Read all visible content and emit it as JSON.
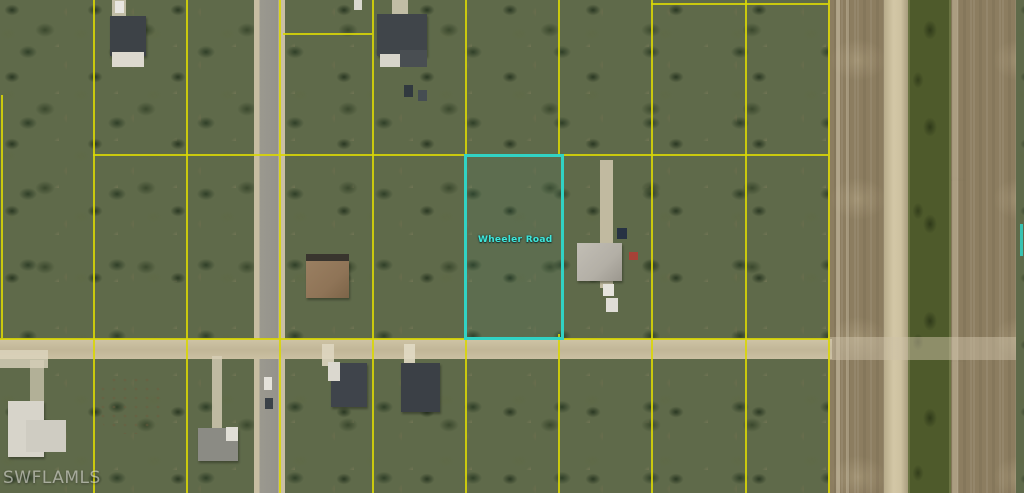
{
  "window": {
    "description": "MLS aerial parcel photo",
    "width": 1024,
    "height": 493
  },
  "watermark": {
    "text": "SWFLAMLS"
  },
  "road_label": {
    "text": "Wheeler Road"
  },
  "palette": {
    "parcel_line": "#d9d606",
    "highlight": "#31d2c4",
    "veg_base": "#5f6a4a",
    "sand": "#cfc3a4",
    "field": "#8c7d60",
    "canal": "#4e5a2b",
    "asphalt": "#98968c",
    "dirt_road": "#c6bb9e"
  },
  "highlight_parcel": {
    "x": 464,
    "y": 154,
    "w": 94,
    "h": 180
  },
  "grid": {
    "vertical": [
      {
        "x": 1,
        "y1": 95,
        "y2": 338
      },
      {
        "x": 93,
        "y1": 0,
        "y2": 493
      },
      {
        "x": 186,
        "y1": 0,
        "y2": 493
      },
      {
        "x": 279,
        "y1": 0,
        "y2": 493
      },
      {
        "x": 372,
        "y1": 0,
        "y2": 493
      },
      {
        "x": 465,
        "y1": 0,
        "y2": 155
      },
      {
        "x": 465,
        "y1": 334,
        "y2": 493
      },
      {
        "x": 558,
        "y1": 0,
        "y2": 155
      },
      {
        "x": 558,
        "y1": 334,
        "y2": 493
      },
      {
        "x": 651,
        "y1": 0,
        "y2": 493
      },
      {
        "x": 745,
        "y1": 0,
        "y2": 493
      },
      {
        "x": 828,
        "y1": 0,
        "y2": 493
      }
    ],
    "horizontal": [
      {
        "y": 3,
        "x1": 651,
        "x2": 828
      },
      {
        "y": 33,
        "x1": 283,
        "x2": 372
      },
      {
        "y": 154,
        "x1": 93,
        "x2": 828
      },
      {
        "y": 338,
        "x1": 0,
        "x2": 829
      }
    ]
  },
  "scene": {
    "ground": [
      {
        "name": "vegetation-base",
        "x": 0,
        "y": 0,
        "w": 1024,
        "h": 493,
        "cls": "veg"
      },
      {
        "name": "field-strip",
        "x": 828,
        "y": 0,
        "w": 196,
        "h": 493,
        "cls": "field"
      },
      {
        "name": "field-path-line",
        "x": 836,
        "y": 0,
        "w": 4,
        "h": 493,
        "bg": "rgba(215,205,180,0.5)"
      },
      {
        "name": "field-path-line",
        "x": 846,
        "y": 0,
        "w": 3,
        "h": 493,
        "bg": "rgba(210,200,175,0.4)"
      },
      {
        "name": "levee-strip",
        "x": 884,
        "y": 0,
        "w": 24,
        "h": 493,
        "cls": "levee"
      },
      {
        "name": "canal",
        "x": 908,
        "y": 0,
        "w": 43,
        "h": 493,
        "cls": "canal"
      },
      {
        "name": "field-east-edge-line",
        "x": 952,
        "y": 0,
        "w": 6,
        "h": 493,
        "bg": "rgba(228,218,192,0.35)"
      },
      {
        "name": "vegetation-sliver-east",
        "x": 1016,
        "y": 0,
        "w": 8,
        "h": 493,
        "cls": "veg"
      }
    ],
    "sand": [
      {
        "name": "sand-clearing",
        "x": 55,
        "y": 90,
        "w": 150,
        "h": 110,
        "op": 0.85
      },
      {
        "name": "sand-clearing",
        "x": 90,
        "y": 0,
        "w": 100,
        "h": 110,
        "op": 0.6
      },
      {
        "name": "sand-clearing",
        "x": 360,
        "y": 0,
        "w": 110,
        "h": 155,
        "op": 0.95
      },
      {
        "name": "sand-clearing",
        "x": 205,
        "y": 0,
        "w": 55,
        "h": 35,
        "op": 0.5
      },
      {
        "name": "sand-clearing",
        "x": 275,
        "y": 190,
        "w": 100,
        "h": 155,
        "op": 0.95
      },
      {
        "name": "sand-clearing",
        "x": 560,
        "y": 225,
        "w": 90,
        "h": 100,
        "op": 0.8
      },
      {
        "name": "sand-clearing",
        "x": 465,
        "y": 215,
        "w": 95,
        "h": 110,
        "op": 0.5
      },
      {
        "name": "sand-clearing",
        "x": 655,
        "y": 55,
        "w": 90,
        "h": 80,
        "op": 0.4
      },
      {
        "name": "sand-clearing",
        "x": 690,
        "y": 345,
        "w": 140,
        "h": 148,
        "op": 0.9
      },
      {
        "name": "sand-clearing",
        "x": 88,
        "y": 362,
        "w": 100,
        "h": 85,
        "op": 0.85
      },
      {
        "name": "sand-clearing",
        "x": 0,
        "y": 385,
        "w": 80,
        "h": 90,
        "op": 0.7
      },
      {
        "name": "sand-clearing",
        "x": 180,
        "y": 410,
        "w": 80,
        "h": 85,
        "op": 0.6
      },
      {
        "name": "sand-clearing",
        "x": 940,
        "y": 300,
        "w": 80,
        "h": 60,
        "op": 0.8
      },
      {
        "name": "sand-clearing",
        "x": 830,
        "y": 0,
        "w": 55,
        "h": 130,
        "op": 0.5
      },
      {
        "name": "mulch-pile",
        "x": 98,
        "y": 376,
        "w": 64,
        "h": 58,
        "cls": "mulch",
        "op": 0.9
      }
    ],
    "roads": [
      {
        "name": "road-vertical",
        "x": 254,
        "y": 0,
        "w": 31,
        "h": 493,
        "bg": "linear-gradient(90deg,#c7bda2 0px,#c7bda2 5px,#9b998f 6px,#94928b 24px,#c9bfa4 25px,#c9bfa4 31px)"
      },
      {
        "name": "road-horizontal",
        "x": 0,
        "y": 339,
        "w": 832,
        "h": 20,
        "bg": "linear-gradient(180deg,#cfc4a6 0%,#c1b697 55%,#cbc0a2 100%)"
      },
      {
        "name": "road-horizontal-fade",
        "x": 828,
        "y": 337,
        "w": 188,
        "h": 23,
        "bg": "rgba(205,194,168,0.5)"
      }
    ],
    "driveways": [
      {
        "name": "driveway",
        "x": 600,
        "y": 160,
        "w": 13,
        "h": 128,
        "bg": "rgba(210,200,175,0.85)"
      },
      {
        "name": "driveway",
        "x": 322,
        "y": 344,
        "w": 12,
        "h": 22,
        "bg": "rgba(222,214,192,0.9)"
      },
      {
        "name": "driveway",
        "x": 404,
        "y": 344,
        "w": 11,
        "h": 20,
        "bg": "rgba(225,218,196,0.9)"
      },
      {
        "name": "driveway",
        "x": 212,
        "y": 356,
        "w": 10,
        "h": 72,
        "bg": "rgba(215,206,182,0.8)"
      },
      {
        "name": "driveway",
        "x": 0,
        "y": 350,
        "w": 48,
        "h": 18,
        "bg": "rgba(220,212,190,0.8)"
      },
      {
        "name": "driveway",
        "x": 30,
        "y": 360,
        "w": 14,
        "h": 42,
        "bg": "rgba(214,206,184,0.7)"
      },
      {
        "name": "driveway",
        "x": 112,
        "y": 0,
        "w": 14,
        "h": 16,
        "bg": "rgba(218,210,188,0.8)"
      },
      {
        "name": "driveway",
        "x": 392,
        "y": 0,
        "w": 16,
        "h": 14,
        "bg": "rgba(218,210,188,0.8)"
      }
    ],
    "structures": [
      {
        "name": "house-roof",
        "x": 110,
        "y": 16,
        "w": 36,
        "h": 40,
        "bg": "#3d4247",
        "cls": "roof"
      },
      {
        "name": "house-roof-section",
        "x": 112,
        "y": 52,
        "w": 32,
        "h": 15,
        "bg": "#ddd9cf"
      },
      {
        "name": "house-roof",
        "x": 377,
        "y": 14,
        "w": 50,
        "h": 42,
        "bg": "#40454a",
        "cls": "roof"
      },
      {
        "name": "house-roof-section",
        "x": 400,
        "y": 50,
        "w": 27,
        "h": 17,
        "bg": "#494e52"
      },
      {
        "name": "house-roof-section",
        "x": 380,
        "y": 54,
        "w": 20,
        "h": 13,
        "bg": "#d7d4ca"
      },
      {
        "name": "house-roof-eave",
        "x": 306,
        "y": 254,
        "w": 43,
        "h": 8,
        "bg": "#39352e"
      },
      {
        "name": "house-roof",
        "x": 306,
        "y": 261,
        "w": 43,
        "h": 37,
        "bg": "linear-gradient(135deg,#9a7f61,#8f7457 60%,#7c6448)",
        "cls": "roof"
      },
      {
        "name": "house-roof",
        "x": 577,
        "y": 243,
        "w": 45,
        "h": 38,
        "bg": "linear-gradient(135deg,#c2beb5,#b3afa6 60%,#9b978e)",
        "cls": "roof"
      },
      {
        "name": "house-roof",
        "x": 8,
        "y": 401,
        "w": 36,
        "h": 56,
        "bg": "#d7d4ca",
        "cls": "roof"
      },
      {
        "name": "house-roof-section",
        "x": 26,
        "y": 420,
        "w": 40,
        "h": 32,
        "bg": "#cfccc2"
      },
      {
        "name": "house-roof",
        "x": 198,
        "y": 428,
        "w": 40,
        "h": 33,
        "bg": "#8b8b84",
        "cls": "roof"
      },
      {
        "name": "house-roof-section",
        "x": 226,
        "y": 427,
        "w": 12,
        "h": 14,
        "bg": "#e0ded6"
      },
      {
        "name": "house-roof",
        "x": 331,
        "y": 363,
        "w": 36,
        "h": 44,
        "bg": "#3f444b",
        "cls": "roof"
      },
      {
        "name": "house-roof-section",
        "x": 328,
        "y": 362,
        "w": 12,
        "h": 19,
        "bg": "#dbd8cf"
      },
      {
        "name": "house-roof",
        "x": 401,
        "y": 363,
        "w": 39,
        "h": 49,
        "bg": "#3b4046",
        "cls": "roof"
      }
    ],
    "vehicles": [
      {
        "name": "vehicle",
        "x": 115,
        "y": 1,
        "w": 9,
        "h": 12,
        "bg": "#e8e6e0"
      },
      {
        "name": "vehicle",
        "x": 354,
        "y": 0,
        "w": 8,
        "h": 10,
        "bg": "#dad8d0"
      },
      {
        "name": "vehicle",
        "x": 404,
        "y": 85,
        "w": 9,
        "h": 12,
        "bg": "#31393f"
      },
      {
        "name": "vehicle",
        "x": 418,
        "y": 90,
        "w": 9,
        "h": 11,
        "bg": "#454d52"
      },
      {
        "name": "vehicle",
        "x": 617,
        "y": 228,
        "w": 10,
        "h": 11,
        "bg": "#273243"
      },
      {
        "name": "vehicle",
        "x": 629,
        "y": 252,
        "w": 9,
        "h": 8,
        "bg": "#a64237"
      },
      {
        "name": "vehicle",
        "x": 603,
        "y": 284,
        "w": 11,
        "h": 12,
        "bg": "#e6e4dd"
      },
      {
        "name": "vehicle",
        "x": 606,
        "y": 298,
        "w": 12,
        "h": 14,
        "bg": "#dfddd6"
      },
      {
        "name": "vehicle",
        "x": 264,
        "y": 377,
        "w": 8,
        "h": 13,
        "bg": "#e4e2db"
      },
      {
        "name": "vehicle",
        "x": 265,
        "y": 398,
        "w": 8,
        "h": 11,
        "bg": "#3a4148"
      }
    ],
    "fragments": [
      {
        "name": "highlight-fragment-east",
        "x": 1020,
        "y": 224,
        "w": 3,
        "h": 32,
        "bg": "#31d2c4",
        "op": 0.85
      }
    ]
  }
}
